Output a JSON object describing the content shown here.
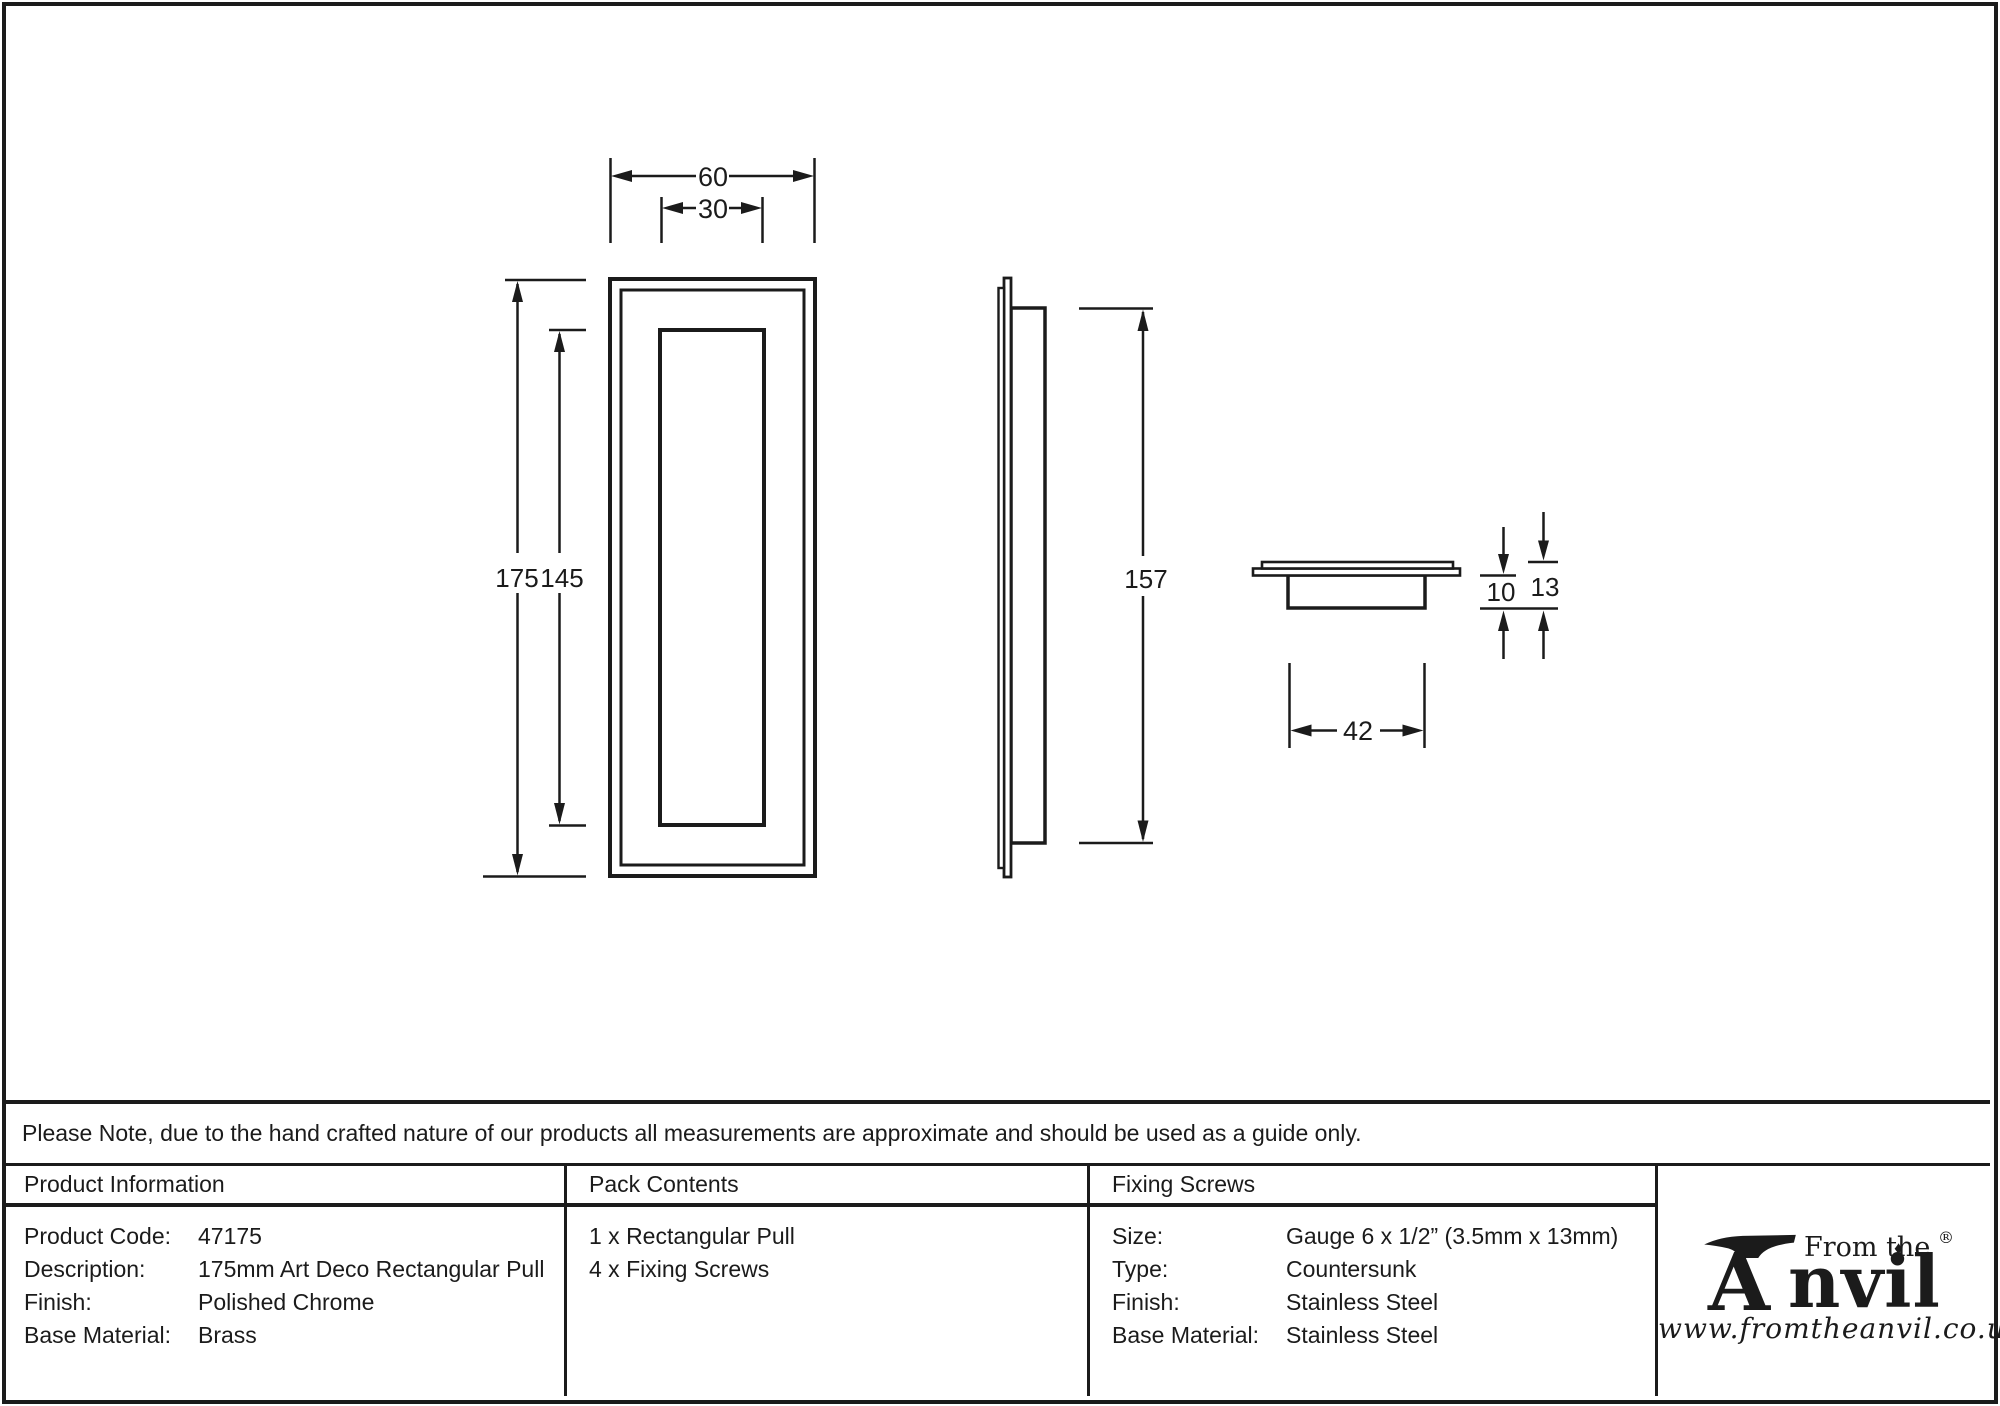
{
  "note": "Please Note, due to the hand crafted nature of our products all measurements are approximate and should be used as a guide only.",
  "drawing": {
    "front_view": {
      "width_outer": "60",
      "width_inner": "30",
      "height_outer": "175",
      "height_inner": "145"
    },
    "side_view": {
      "recess_height": "157"
    },
    "top_view": {
      "recess_width": "42",
      "recess_depth": "10",
      "total_depth": "13"
    }
  },
  "table": {
    "product_info": {
      "header": "Product Information",
      "rows": [
        {
          "label": "Product Code:",
          "value": "47175"
        },
        {
          "label": "Description:",
          "value": "175mm Art Deco Rectangular Pull"
        },
        {
          "label": "Finish:",
          "value": "Polished Chrome"
        },
        {
          "label": "Base Material:",
          "value": "Brass"
        }
      ]
    },
    "pack_contents": {
      "header": "Pack Contents",
      "items": [
        "1 x Rectangular Pull",
        "4 x Fixing Screws"
      ]
    },
    "fixing_screws": {
      "header": "Fixing Screws",
      "rows": [
        {
          "label": "Size:",
          "value": "Gauge 6 x 1/2” (3.5mm x 13mm)"
        },
        {
          "label": "Type:",
          "value": "Countersunk"
        },
        {
          "label": "Finish:",
          "value": "Stainless Steel"
        },
        {
          "label": "Base Material:",
          "value": "Stainless Steel"
        }
      ]
    }
  },
  "logo": {
    "prefix": "From the",
    "diamond": "♦",
    "name_initial": "A",
    "name_rest": "nvil",
    "registered": "®",
    "url": "www.fromtheanvil.co.uk"
  }
}
